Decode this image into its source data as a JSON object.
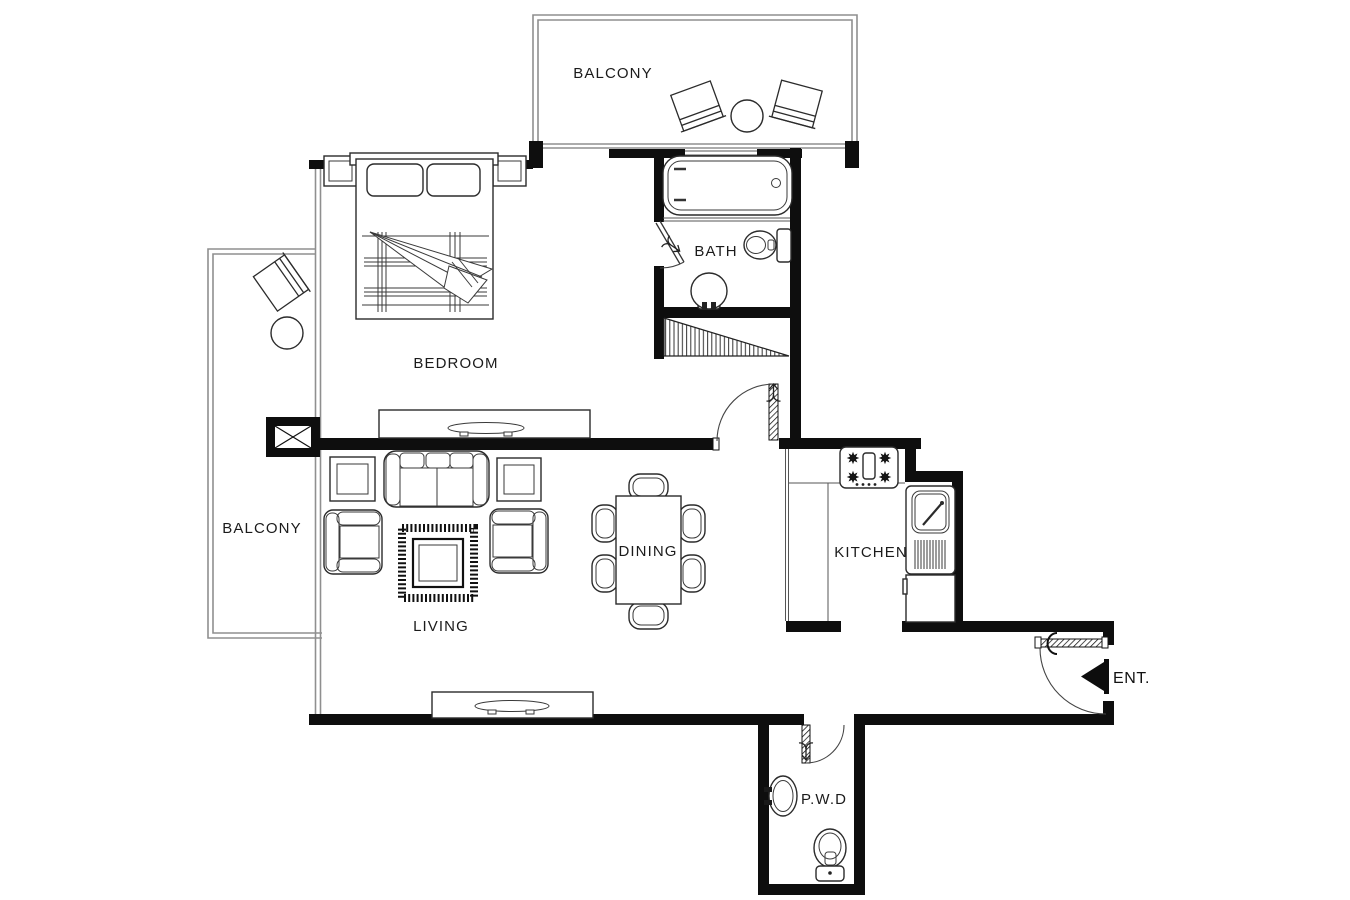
{
  "canvas": {
    "width": 1350,
    "height": 900,
    "background": "#ffffff"
  },
  "colors": {
    "wall": "#0e0e0e",
    "furniture_line": "#2b2b2b",
    "window_railing_line": "#8f8f8f",
    "label_text": "#1b1b1b"
  },
  "rooms": [
    {
      "id": "balcony_top",
      "label": "BALCONY"
    },
    {
      "id": "bedroom",
      "label": "BEDROOM"
    },
    {
      "id": "bath",
      "label": "BATH"
    },
    {
      "id": "balcony_left",
      "label": "BALCONY"
    },
    {
      "id": "living",
      "label": "LIVING"
    },
    {
      "id": "dining",
      "label": "DINING"
    },
    {
      "id": "kitchen",
      "label": "KITCHEN"
    },
    {
      "id": "powder_room",
      "label": "P.W.D"
    },
    {
      "id": "entrance",
      "label": "ENT."
    }
  ],
  "fixtures": {
    "balcony_top": [
      "patio-chair",
      "round-table",
      "patio-chair"
    ],
    "balcony_left": [
      "patio-chair",
      "round-table"
    ],
    "bedroom": [
      "double-bed",
      "pillow",
      "pillow",
      "nightstand",
      "nightstand",
      "tv-console"
    ],
    "bath": [
      "bathtub",
      "toilet",
      "pedestal-sink",
      "hatched-stair-flight"
    ],
    "living": [
      "sofa",
      "side-table",
      "armchair",
      "coffee-table-on-rug",
      "armchair",
      "side-table",
      "tv-console"
    ],
    "dining": [
      "dining-table",
      "dining-chair",
      "dining-chair",
      "dining-chair",
      "dining-chair",
      "dining-chair",
      "dining-chair"
    ],
    "kitchen": [
      "gas-stove-4-burner",
      "counter",
      "sink-with-drainboard",
      "refrigerator"
    ],
    "powder_room": [
      "wash-basin",
      "toilet"
    ],
    "structure": [
      "column-marker"
    ],
    "doors": [
      "bedroom-bath-door",
      "hallway-door",
      "kitchen-opening",
      "entrance-door",
      "powder-room-door"
    ]
  }
}
